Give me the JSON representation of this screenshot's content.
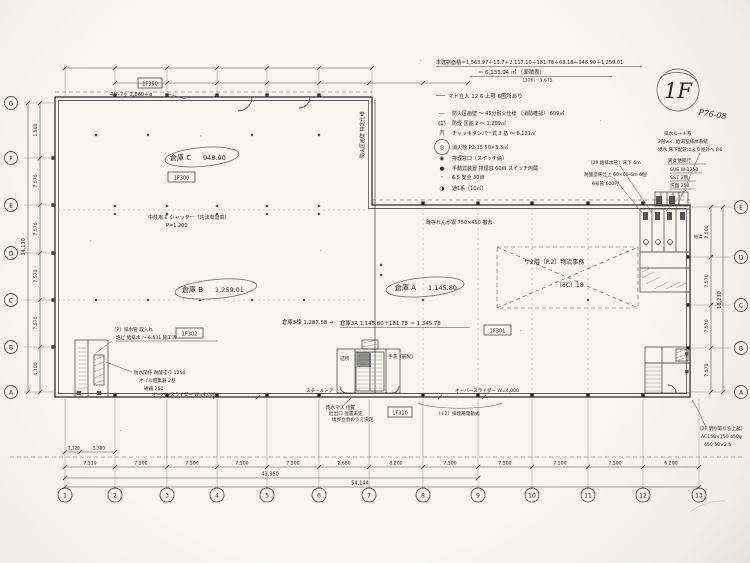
{
  "stamps": {
    "floor": "1F",
    "page": "P76-08"
  },
  "header_notes": {
    "line1": "本建物面積＝1,563.97＋13.7＋2,117.10＋181.78＋63.18＋948.90＋1,259.01",
    "line2": "＝ 6,133.94 ㎡ 〔面積表〕",
    "line3": "〔306〕 3,675",
    "line4": "マド立入 12.6 上限 6箇所あり"
  },
  "legend": {
    "items": [
      {
        "sym": "―",
        "text": "防火区画壁 〜 45分耐火仕様 〔消防確認〕 609㎡"
      },
      {
        "sym": "(1)",
        "text": "防煙 区画 2 〜 1,209㎡"
      },
      {
        "sym": "汽",
        "text": "チャッキダンパー式 3 基 〜 6,131㎡"
      },
      {
        "sym": "◎",
        "text": "消火栓 P2-15 50×3.3㎡"
      },
      {
        "sym": "◉",
        "text": "排煙窓口〔スイッチ納〕"
      },
      {
        "sym": "●",
        "text": "手動式装置 排煙窓 60W スイッチ内蔵"
      },
      {
        "sym": "・",
        "text": "6.5 安全 30W"
      },
      {
        "sym": "◑",
        "text": "通1系〔10㎡〕"
      }
    ]
  },
  "rooms": [
    {
      "name": "倉庫 C",
      "area": "948.90",
      "tag": "1F300"
    },
    {
      "name": "倉庫 B",
      "area": "1,259.01",
      "tag": "1F302"
    },
    {
      "name": "倉庫 A",
      "area": "1,145.80",
      "tag": "1F301"
    }
  ],
  "labels": {
    "calc": "倉庫3A 1,145.80＋181.78 ＝ 1,345.78",
    "storage_total": "倉庫3棟 1,287.58 →",
    "mezzanine": "サ2階〔P.2〕物流事務",
    "mezzanine_sub": "〔8C〕18",
    "top_tag": "1F350",
    "bottom_tag": "1F310"
  },
  "annotations": {
    "container": "4ド-7ヶ 2,860＋α",
    "shutter": "中柱用 C シャッター〔内法有効高〕",
    "shutter_sub": "P=1,200",
    "firewall_v": "防火区画壁 特定仕様",
    "brick": "既存れんが塀 750×450 撤去",
    "drain_route": "排水ルート系",
    "wc_drain": "2階w.c. 給湯室排水系統",
    "spring": "湧水 床下配管により屋外へ P.6",
    "mens": "男女便所行",
    "sus": "SUS W-1250",
    "st": "S&T 2階",
    "senmen": "洗面 250",
    "pipe2f": "〔2P 給排水管〕床下 6m",
    "acid_floor": "耐酸塗床仕上 60×60-6m 6個",
    "pipe6": "6号管 600吋",
    "kyuto": "給湯",
    "skylight": "〔2F 明り取り窓上部〕",
    "ac150": "AC150×150 450φ",
    "s450": "450 50×2.5",
    "overslider_l": "オーバースライダー W=4,000",
    "overslider_r": "オーバースライダー W=4,000",
    "smoke_motor": "〔+2〕排煙用電動式",
    "steel_door": "スチールドア",
    "rain1": "雨水マス 位置",
    "rain2": "吐出口 位置未定",
    "rain3": "境界立会のうえ決定",
    "p_drain": "〔P〕排水管 取入れ",
    "vinyl": "塩ビ 給排水 〜 6,531 施工済",
    "water1": "防水関係 耐酸塗り 1250",
    "water2": "オイル阻集器 2基",
    "water3": "磁器 250",
    "tsumesho": "詰所",
    "tearai": "手洗〔鋼製〕"
  },
  "grid": {
    "cols": [
      "1",
      "2",
      "3",
      "4",
      "5",
      "6",
      "7",
      "8",
      "9",
      "10",
      "11",
      "12",
      "13"
    ],
    "rows_left": [
      "G",
      "F",
      "E",
      "D",
      "C",
      "B",
      "A"
    ],
    "rows_right": [
      "E",
      "D",
      "C",
      "B",
      "A"
    ]
  },
  "dims": {
    "bottom_sub": [
      "2,120",
      "5,380"
    ],
    "bottom": [
      "7,510",
      "7,500",
      "7,500",
      "7,500",
      "7,500",
      "2,680",
      "8,200",
      "7,500",
      "7,500",
      "7,500",
      "7,500",
      "6,200"
    ],
    "bottom_total_inner": "43,360",
    "bottom_total": "54,144",
    "left": [
      "1,500",
      "7,570",
      "7,570",
      "7,570",
      "7,570",
      "4,100"
    ],
    "left_total": "34,130",
    "right": [
      "2,500",
      "7,570",
      "7,570",
      "7,570"
    ],
    "right_total": "18,230"
  }
}
